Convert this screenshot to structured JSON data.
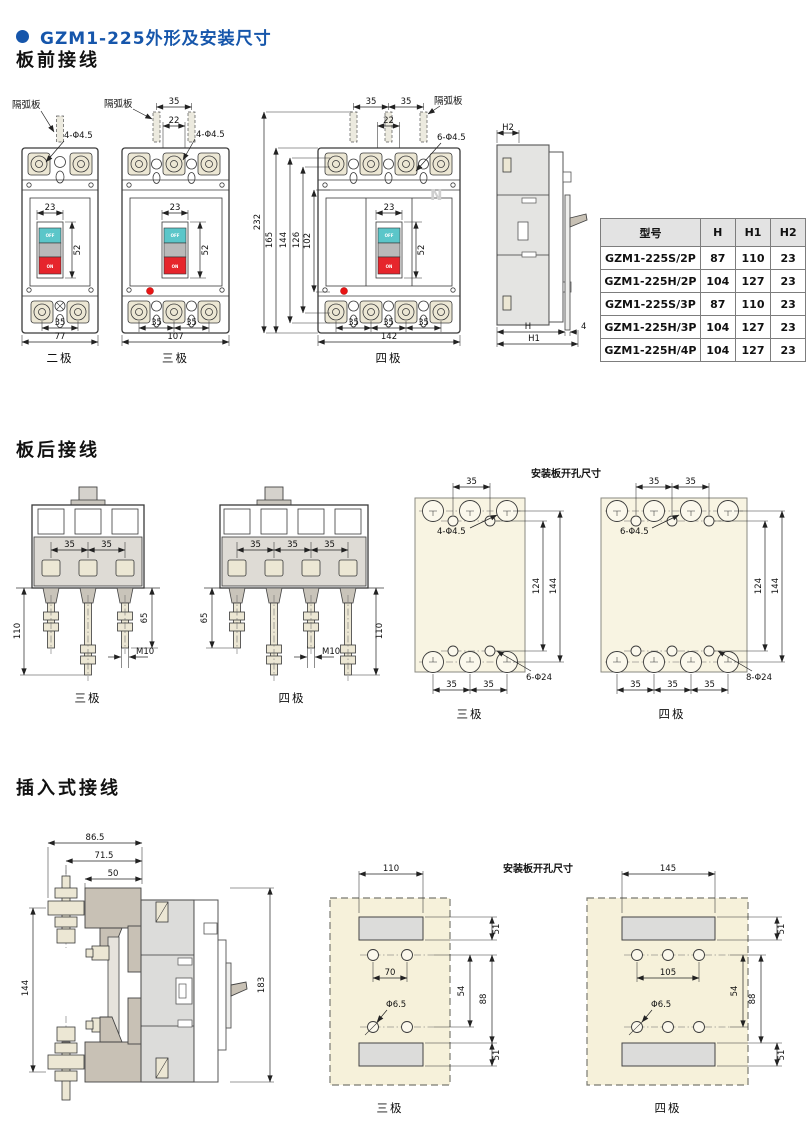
{
  "header": {
    "title": "GZM1-225外形及安装尺寸"
  },
  "headings": {
    "front": "板前接线",
    "rear": "板后接线",
    "plugin": "插入式接线"
  },
  "common": {
    "off": "OFF",
    "on": "ON",
    "arc_plate": "隔弧板",
    "plate_title": "安装板开孔尺寸",
    "pole2": "二极",
    "pole3": "三极",
    "pole4": "四极"
  },
  "front2": {
    "holes": "4-Φ4.5",
    "handle_w": "23",
    "handle_h": "52",
    "pitch": "35",
    "width": "77"
  },
  "front3": {
    "top_pitch": "35",
    "top_gap": "22",
    "holes": "4-Φ4.5",
    "handle_w": "23",
    "handle_h": "52",
    "pitch1": "35",
    "pitch2": "35",
    "width": "107"
  },
  "front4": {
    "top_pitch1": "35",
    "top_pitch2": "35",
    "top_gap": "22",
    "holes": "6-Φ4.5",
    "handle_w": "23",
    "handle_h": "52",
    "neutral": "N",
    "v232": "232",
    "v165": "165",
    "v144": "144",
    "v126": "126",
    "v102": "102",
    "pitch1": "35",
    "pitch2": "35",
    "pitch3": "35",
    "width": "142"
  },
  "side": {
    "h2": "H2",
    "h": "H",
    "gap4": "4",
    "h1": "H1"
  },
  "spec_table": {
    "headers": [
      "型号",
      "H",
      "H1",
      "H2"
    ],
    "rows": [
      [
        "GZM1-225S/2P",
        "87",
        "110",
        "23"
      ],
      [
        "GZM1-225H/2P",
        "104",
        "127",
        "23"
      ],
      [
        "GZM1-225S/3P",
        "87",
        "110",
        "23"
      ],
      [
        "GZM1-225H/3P",
        "104",
        "127",
        "23"
      ],
      [
        "GZM1-225H/4P",
        "104",
        "127",
        "23"
      ]
    ]
  },
  "rear3": {
    "pitch1": "35",
    "pitch2": "35",
    "v110": "110",
    "v65": "65",
    "thread": "M10"
  },
  "rear4": {
    "pitch1": "35",
    "pitch2": "35",
    "pitch3": "35",
    "v65": "65",
    "v110": "110",
    "thread": "M10"
  },
  "rplate3": {
    "top_pitch": "35",
    "small_holes": "4-Φ4.5",
    "v124": "124",
    "v144": "144",
    "pitch1": "35",
    "pitch2": "35",
    "big_holes": "6-Φ24"
  },
  "rplate4": {
    "top_pitch1": "35",
    "top_pitch2": "35",
    "small_holes": "6-Φ4.5",
    "v124": "124",
    "v144": "144",
    "pitch1": "35",
    "pitch2": "35",
    "pitch3": "35",
    "big_holes": "8-Φ24"
  },
  "plugside": {
    "d865": "86.5",
    "d715": "71.5",
    "d50": "50",
    "v144": "144",
    "v183": "183"
  },
  "pplate3": {
    "width": "110",
    "s51t": "51",
    "pitch": "70",
    "hole": "Φ6.5",
    "v54": "54",
    "v88": "88",
    "s51b": "51"
  },
  "pplate4": {
    "width": "145",
    "s51t": "51",
    "pitch": "105",
    "hole": "Φ6.5",
    "v54": "54",
    "v88": "88",
    "s51b": "51"
  }
}
